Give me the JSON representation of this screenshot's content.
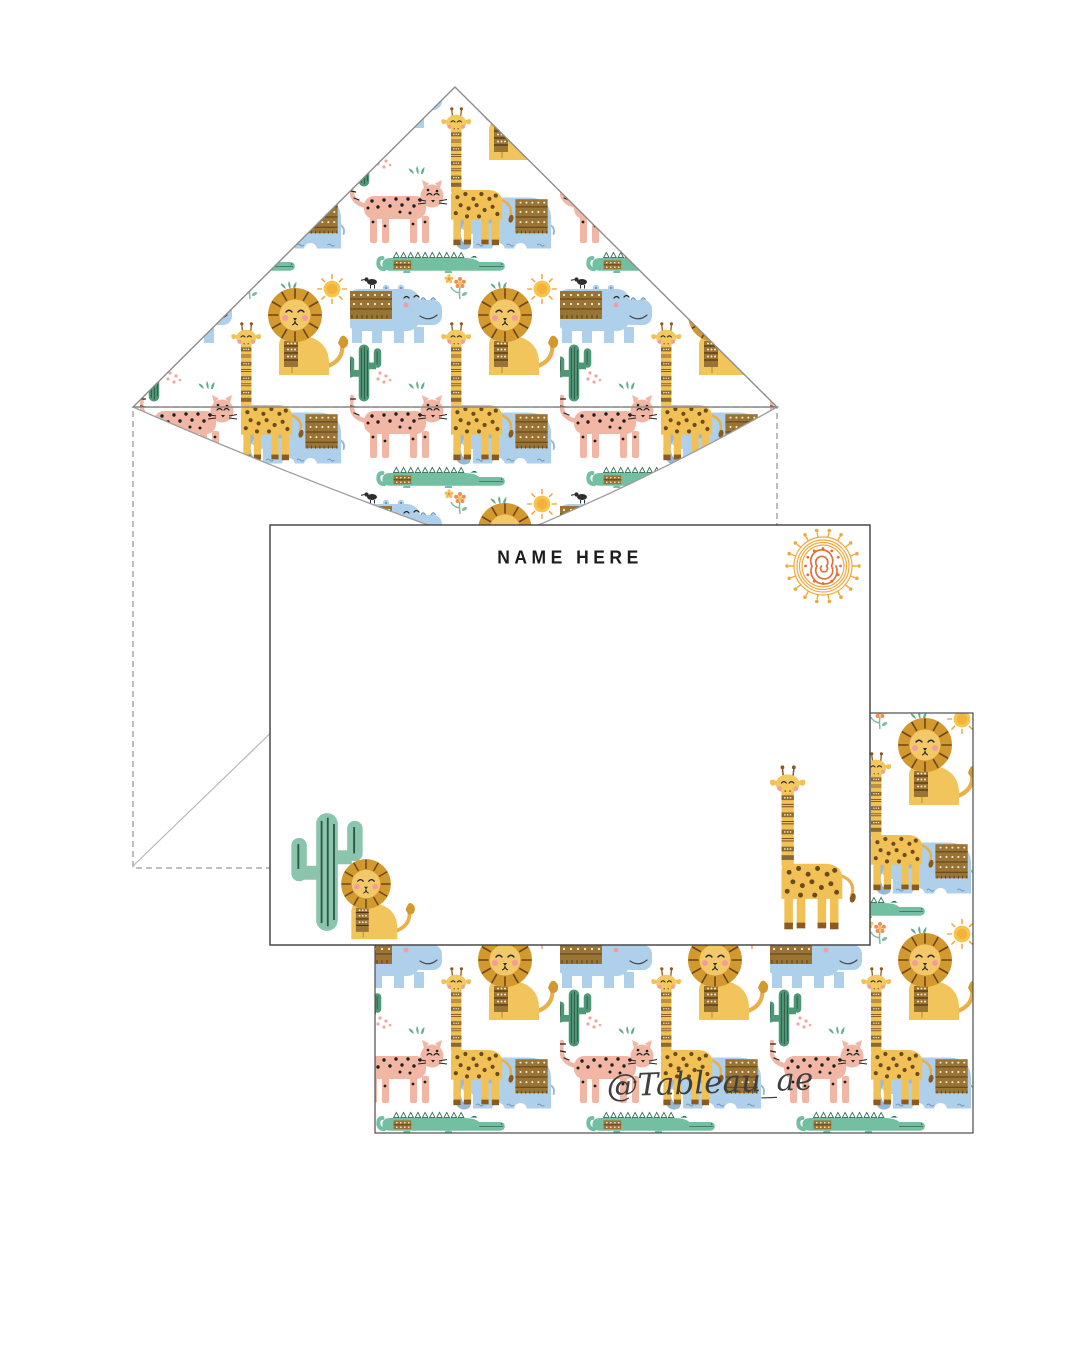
{
  "page": {
    "background_color": "#ffffff",
    "description": "Safari animals notecard and lined envelope stationery mockup"
  },
  "envelope": {
    "liner_theme": "safari-animals",
    "liner_animals": [
      "lion",
      "giraffe",
      "elephant",
      "hippo",
      "leopard",
      "crocodile"
    ],
    "liner_motifs": [
      "cactus",
      "sun",
      "grass",
      "flowers",
      "dots"
    ]
  },
  "notecard": {
    "title": "NAME HERE",
    "decorations": [
      "spiral-sun",
      "cactus",
      "lion",
      "giraffe"
    ]
  },
  "pattern_card": {
    "watermark_handle": "@Tableau_ae",
    "pattern_theme": "safari-animals"
  },
  "colors": {
    "animal_blue": "#afd0eb",
    "animal_blue_dark": "#94b8da",
    "lion_mane": "#d2992e",
    "body_yellow": "#f2c45c",
    "giraffe_yellow": "#f2c155",
    "leopard_pink": "#f1b7a4",
    "crocodile_teal": "#72bfa2",
    "cactus_teal_light": "#8cc5ae",
    "cactus_teal_dark": "#4e9878",
    "tribal_brown": "#9a7434",
    "spot_brown": "#6b4a1e",
    "sun_orange": "#f2a83b",
    "spiral_orange": "#e2703a",
    "cheek_pink": "#f29d9d",
    "ink": "#1c1c1c",
    "watermark_gray": "#3f3f3f",
    "cut_line_gray": "#9a9a9a"
  }
}
